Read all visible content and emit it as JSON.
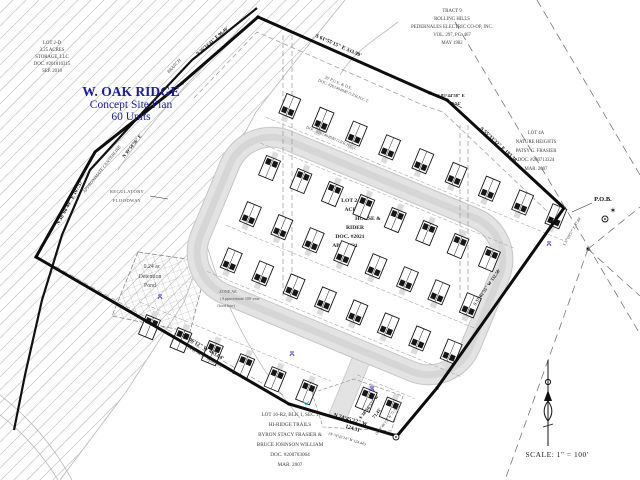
{
  "title": {
    "name": "W. OAK RIDGE",
    "subtitle": "Concept Site Plan",
    "units": "60 Units"
  },
  "scale_label": "SCALE:  1\" = 100'",
  "pob_label": "P.O.B.",
  "adjacent_lots": {
    "lot2d": {
      "lines": [
        "LOT 2-D",
        "3.25 ACRES",
        "STORAGE, LLC",
        "DOC. #201810315",
        "SEP. 2018"
      ]
    },
    "tract9": {
      "lines": [
        "TRACT 9",
        "ROLLING HILLS",
        "PEDERNALES ELECTRIC CO-OP, INC.",
        "VOL. 297, PG. 467",
        "MAY 1982"
      ]
    },
    "lot4a": {
      "lines": [
        "LOT 4A",
        "NATURE HEIGHTS",
        "PATSY G. FRASIER",
        "DOC. #200713324",
        "MAR. 2007"
      ]
    },
    "lot16r2": {
      "lines": [
        "LOT 16-R2, BLK 1, SEC 1",
        "HI-RIDGE TRAILS",
        "BYRON STACY FRASIER &",
        "BRUCE JOHNSON WILLIAM",
        "DOC. #200703064",
        "MAR. 2007"
      ]
    },
    "lot2e": {
      "lines": [
        "LOT 2-E",
        "ACRES",
        "HORSE &",
        "RIDER",
        "DOC. #2021",
        "APR. 2021"
      ]
    }
  },
  "site_notes": {
    "regulatory_floodway": [
      "REGULATORY",
      "FLOODWAY"
    ],
    "detention_pond": [
      "0.24 ac",
      "Detention",
      "Pond"
    ],
    "flood_zone": [
      "ZONE AE",
      "(Approximate 100-year",
      "flood line)"
    ],
    "centerline": "APPROXIMATE CENTERLINE",
    "creek": "BRANCH",
    "pue": "20' P.U.E. & D.E.",
    "pue_doc": "DOC. #201404940 O.P.R.H.C.T.",
    "pue2": "P.U.E.",
    "pue2_doc": "DOC. #201404940 O.P.R.H.C.T."
  },
  "bearings": {
    "nw": "N 56°14'41\" E   96.46'",
    "top": "S 61°55'15\" E  333.99'",
    "jog_dir": "S 85°44'58\" E",
    "jog_len": "19.54'",
    "ne": "S 55°33'32\" E  183.38'",
    "east": "S 37°02'55\" W  332.50'",
    "se_dir": "S 38°50'57\" W",
    "se_len": "71.45'",
    "se_paren": "(S 38°46'15\" W  71.52')",
    "south_dir": "N 74°45'22\" W",
    "south_len": "124.31'",
    "south_paren": "(N 74°45'14\" W  124.44')",
    "sw": "N 61°06'12\" W  463.04'",
    "sw_paren": "(N 61°04'51\" W  462.95')",
    "west": "N 38°08'49\" E  107.57'",
    "centerline_bearing": "N 39°58'56\" E",
    "pob_tie": "S 37°09'57\" E  37.84'"
  },
  "colors": {
    "title_blue": "#1c1ca0",
    "line_black": "#1a1a1a",
    "road_gray": "#e3e3e3",
    "hatch_gray": "#cdcdcd",
    "marker_blue": "#3b3bd0",
    "marker_cyan": "#28b8cc"
  }
}
